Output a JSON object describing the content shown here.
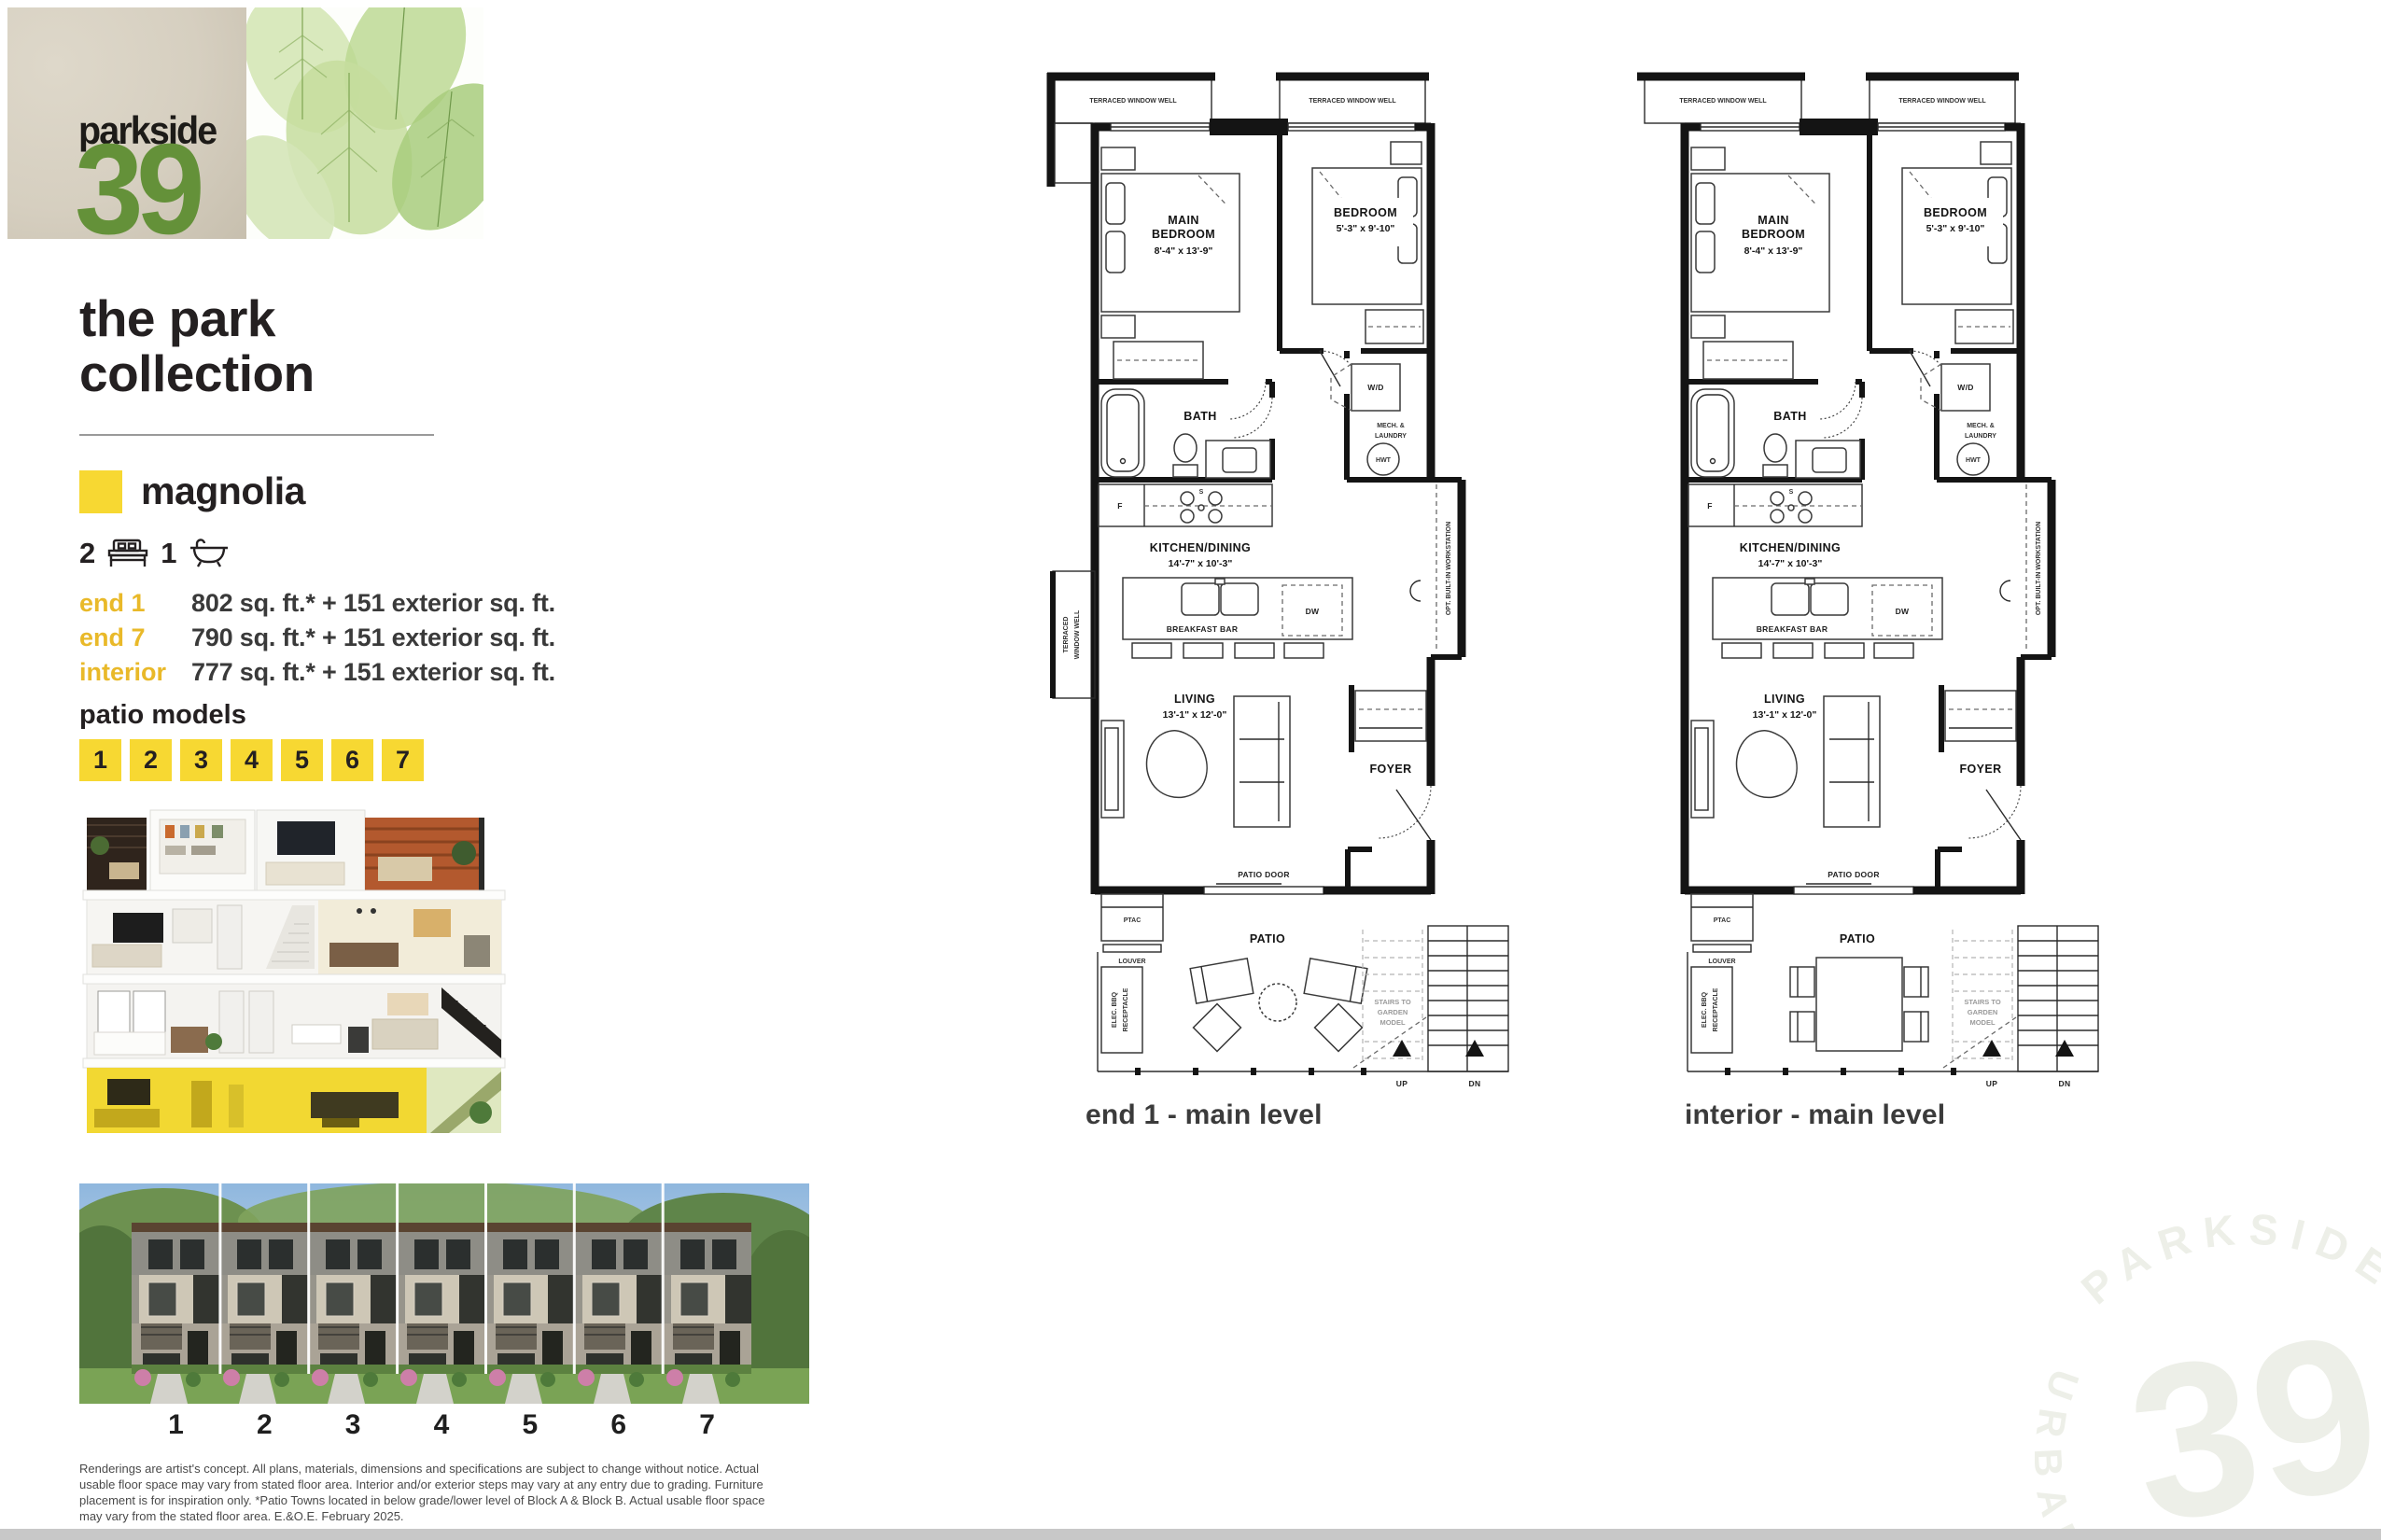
{
  "logo": {
    "brand": "parkside",
    "number": "39"
  },
  "colors": {
    "yellow": "#f7d832",
    "gold": "#e9b929",
    "green": "#649139"
  },
  "sidebar": {
    "title1": "the park",
    "title2": "collection",
    "model_name": "magnolia",
    "stats": {
      "beds": "2",
      "baths": "1"
    },
    "specs": [
      {
        "label": "end 1",
        "value": "802 sq. ft.* + 151 exterior sq. ft."
      },
      {
        "label": "end 7",
        "value": "790 sq. ft.* + 151 exterior sq. ft."
      },
      {
        "label": "interior",
        "value": "777 sq. ft.* + 151 exterior sq. ft."
      }
    ],
    "patio_heading": "patio models",
    "patio_numbers": [
      "1",
      "2",
      "3",
      "4",
      "5",
      "6",
      "7"
    ]
  },
  "building": {
    "numbers": [
      "1",
      "2",
      "3",
      "4",
      "5",
      "6",
      "7"
    ]
  },
  "disclaimer": {
    "text": "Renderings are artist's concept. All plans, materials, dimensions and specifications are subject to change without notice. Actual usable floor space may vary from stated floor area. Interior and/or exterior steps may vary at any entry due to grading. Furniture placement is for inspiration only. *Patio Towns located in below grade/lower level of Block A & Block B.  Actual usable floor space may vary from the stated floor area. E.&O.E. February 2025."
  },
  "plans": [
    {
      "caption": "end 1 - main level",
      "labels": {
        "well": "TERRACED WINDOW WELL",
        "well_v1": "TERRACED",
        "well_v2": "WINDOW WELL",
        "main_bed1": "MAIN",
        "main_bed2": "BEDROOM",
        "main_bed_dims": "8'-4\" x 13'-9\"",
        "bed1": "BEDROOM",
        "bed_dims": "5'-3\" x 9'-10\"",
        "bath": "BATH",
        "wd": "W/D",
        "mech1": "MECH. &",
        "mech2": "LAUNDRY",
        "hwt": "HWT",
        "kitchen": "KITCHEN/DINING",
        "kitchen_dims": "14'-7\" x 10'-3\"",
        "fridge": "F",
        "stove": "S",
        "dw": "DW",
        "breakfast": "BREAKFAST BAR",
        "workstation": "OPT. BUILT-IN WORKSTATION",
        "living": "LIVING",
        "living_dims": "13'-1\" x 12'-0\"",
        "foyer": "FOYER",
        "patio_door": "PATIO DOOR",
        "ptac": "PTAC",
        "louver": "LOUVER",
        "patio": "PATIO",
        "bbq1": "ELEC. BBQ",
        "bbq2": "RECEPTACLE",
        "stairs1": "STAIRS TO",
        "stairs2": "GARDEN",
        "stairs3": "MODEL",
        "up": "UP",
        "dn": "DN"
      }
    },
    {
      "caption": "interior - main level",
      "labels": {
        "well": "TERRACED WINDOW WELL",
        "main_bed1": "MAIN",
        "main_bed2": "BEDROOM",
        "main_bed_dims": "8'-4\" x 13'-9\"",
        "bed1": "BEDROOM",
        "bed_dims": "5'-3\" x 9'-10\"",
        "bath": "BATH",
        "wd": "W/D",
        "mech1": "MECH. &",
        "mech2": "LAUNDRY",
        "hwt": "HWT",
        "kitchen": "KITCHEN/DINING",
        "kitchen_dims": "14'-7\" x 10'-3\"",
        "fridge": "F",
        "stove": "S",
        "dw": "DW",
        "breakfast": "BREAKFAST BAR",
        "workstation": "OPT. BUILT-IN WORKSTATION",
        "living": "LIVING",
        "living_dims": "13'-1\" x 12'-0\"",
        "foyer": "FOYER",
        "patio_door": "PATIO DOOR",
        "ptac": "PTAC",
        "louver": "LOUVER",
        "patio": "PATIO",
        "bbq1": "ELEC. BBQ",
        "bbq2": "RECEPTACLE",
        "stairs1": "STAIRS TO",
        "stairs2": "GARDEN",
        "stairs3": "MODEL",
        "up": "UP",
        "dn": "DN"
      }
    }
  ],
  "watermark": {
    "arc_top": "PARKSIDE",
    "number": "39",
    "arc_left": "URBAN"
  }
}
